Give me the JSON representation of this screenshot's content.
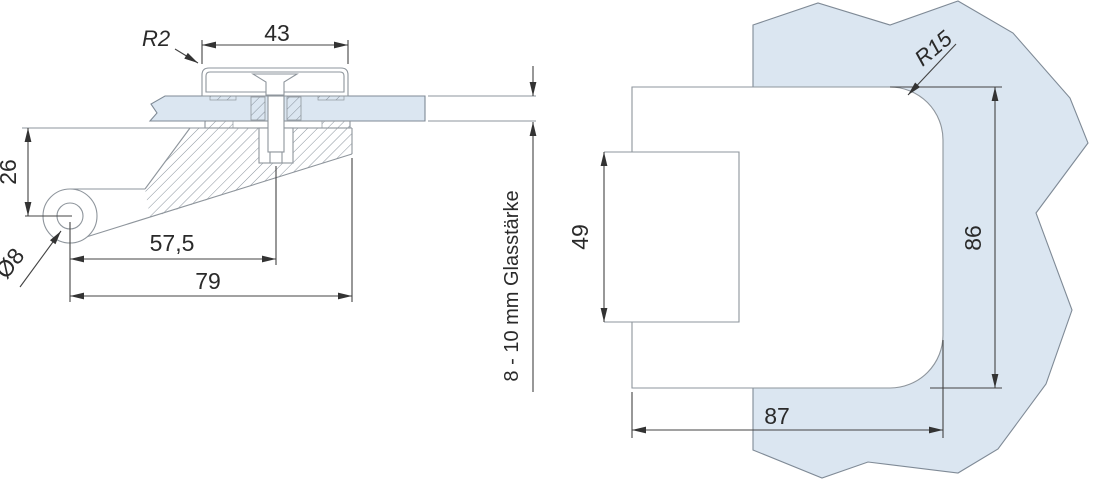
{
  "colors": {
    "background": "#ffffff",
    "glass_fill": "#dbe6f1",
    "part_line": "#8e959c",
    "dimension_line": "#434343",
    "text": "#2a2a2a"
  },
  "left_view": {
    "dims": {
      "cap_width": "43",
      "cap_corner_radius": "R2",
      "pivot_drop": "26",
      "pivot_hole_diameter": "Ø8",
      "screw_axis_distance": "57,5",
      "overall_length": "79",
      "glass_thickness": "8 - 10 mm Glasstärke"
    }
  },
  "right_view": {
    "dims": {
      "corner_radius": "R15",
      "tab_height": "49",
      "body_height": "86",
      "body_width": "87"
    }
  }
}
